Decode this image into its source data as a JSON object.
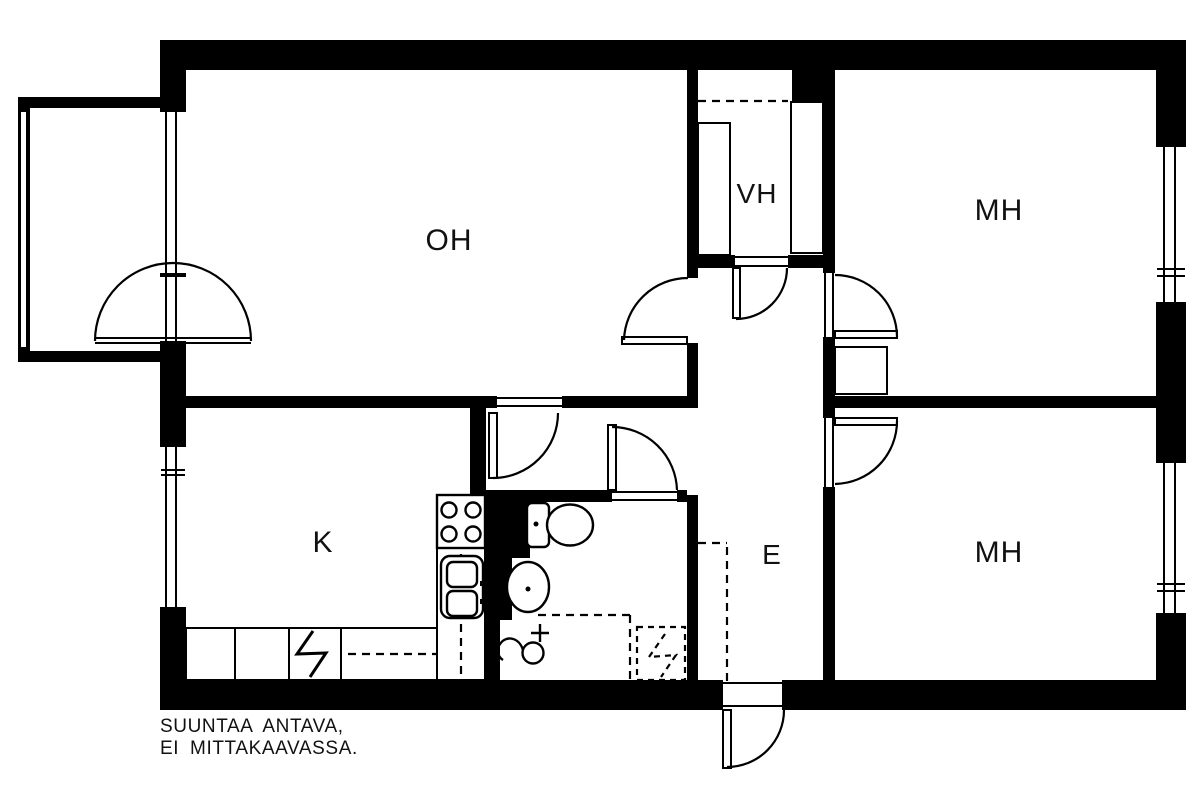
{
  "colors": {
    "wall": "#000000",
    "line": "#000000",
    "background": "#ffffff",
    "text": "#111111"
  },
  "rooms": [
    {
      "id": "living-room",
      "label": "OH"
    },
    {
      "id": "closet",
      "label": "VH"
    },
    {
      "id": "bedroom-top",
      "label": "MH"
    },
    {
      "id": "kitchen",
      "label": "K"
    },
    {
      "id": "hallway",
      "label": "E"
    },
    {
      "id": "bedroom-bottom",
      "label": "MH"
    }
  ],
  "disclaimer": {
    "line1": "SUUNTAA ANTAVA,",
    "line2": "EI MITTAKAAVASSA."
  },
  "fixtures": [
    "stove-icon",
    "double-sink-icon",
    "toilet-icon",
    "washbasin-icon",
    "faucet-icon",
    "electrical-zigzag-icon",
    "washer-reservation-dashed-icon",
    "kitchen-counter",
    "wardrobe",
    "balcony",
    "window",
    "door-swing-arc"
  ]
}
